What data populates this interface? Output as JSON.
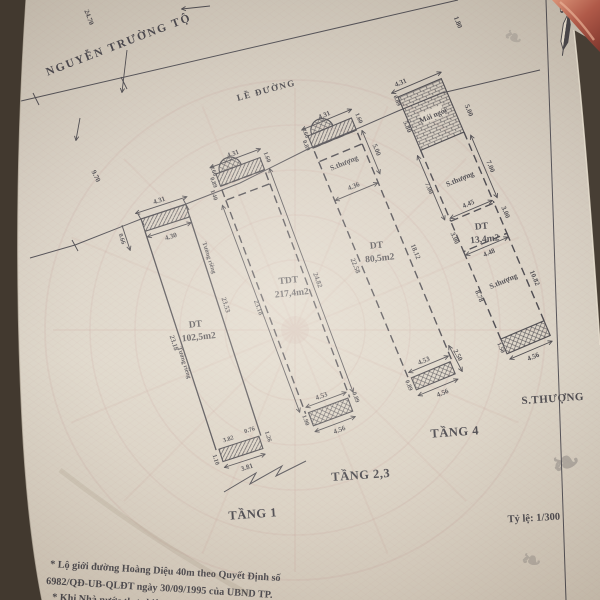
{
  "street": {
    "name": "NGUYỄN TRƯỜNG TỘ",
    "sidewalk": "LỀ ĐƯỜNG",
    "dim_along": "24.70",
    "dim_frontage": "9.70",
    "north_label": "B",
    "direction_arrow": "←"
  },
  "scale": {
    "label": "Tỷ lệ: 1/300"
  },
  "notes": {
    "line1": "* Lộ giới đường Hoàng Diệu 40m theo Quyết Định số",
    "line2": "6982/QĐ-UB-QLĐT ngày 30/09/1995 của UBND TP.",
    "line3": "* Khi Nhà nước thực hiện quy hoạch, chủ sở hữu",
    "line4": "đất ở phải chấp hành..."
  },
  "plans": {
    "p1": {
      "label": "TẦNG 1",
      "area_title": "DT",
      "area": "102,5m2",
      "front": "4.31",
      "front_inner": "4.30",
      "offset_left": "0.66",
      "side_left": "23.18",
      "side_right": "23.53",
      "wall_left": "Tường riêng",
      "wall_right": "Tường riêng",
      "rear_top": "3.82",
      "rear_gap": "0.76",
      "rear": "3.81",
      "rear_left": "1.10",
      "rear_right": "1.26"
    },
    "p2": {
      "label": "TẦNG 2,3",
      "area_title": "TDT",
      "area": "217,4m2",
      "front": "4.31",
      "off1": "0.60",
      "off2": "0.89",
      "off3": "1.40",
      "off_right": "1.60",
      "side_left": "23.18",
      "side_right": "24.82",
      "rear_top": "4.53",
      "rear": "4.56",
      "rear_left": "1.90",
      "rear_right": "0.89"
    },
    "p3": {
      "label": "TẦNG 4",
      "area_title": "DT",
      "area": "80,5m2",
      "terrace": "S.thượng",
      "front": "4.31",
      "off1": "0.60",
      "off2": "0.89",
      "off_right": "1.60",
      "terrace_len": "5.00",
      "terrace_width": "4.36",
      "side_left": "22.58",
      "side_right": "18.12",
      "rear_top": "4.53",
      "rear": "4.56",
      "rear_left": "0.89",
      "rear_offset": "2.50"
    },
    "p4": {
      "label": "S.THƯỢNG",
      "area_title": "DT",
      "area": "13,4m2",
      "front": "4.31",
      "street_offset": "1.80",
      "off_left": "0.89",
      "roof": "Mái ngói",
      "roof_left": "5.80",
      "roof_right": "5.00",
      "terrace_upper": "S.thượng",
      "terr_left": "7.00",
      "terr_right": "7.00",
      "box_top": "4.45",
      "box_bottom": "4.48",
      "box_left": "3.00",
      "box_right": "3.00",
      "terrace_lower": "S.thượng",
      "lower_left": "8.78",
      "lower_right": "10.82",
      "rear_strip": "1.50",
      "rear": "4.56"
    }
  },
  "colors": {
    "ink": "#33323a",
    "paper": "#d8d0c4",
    "watermark": "#b97f7a",
    "background": "#3a332b",
    "copper": "#b05a49"
  }
}
